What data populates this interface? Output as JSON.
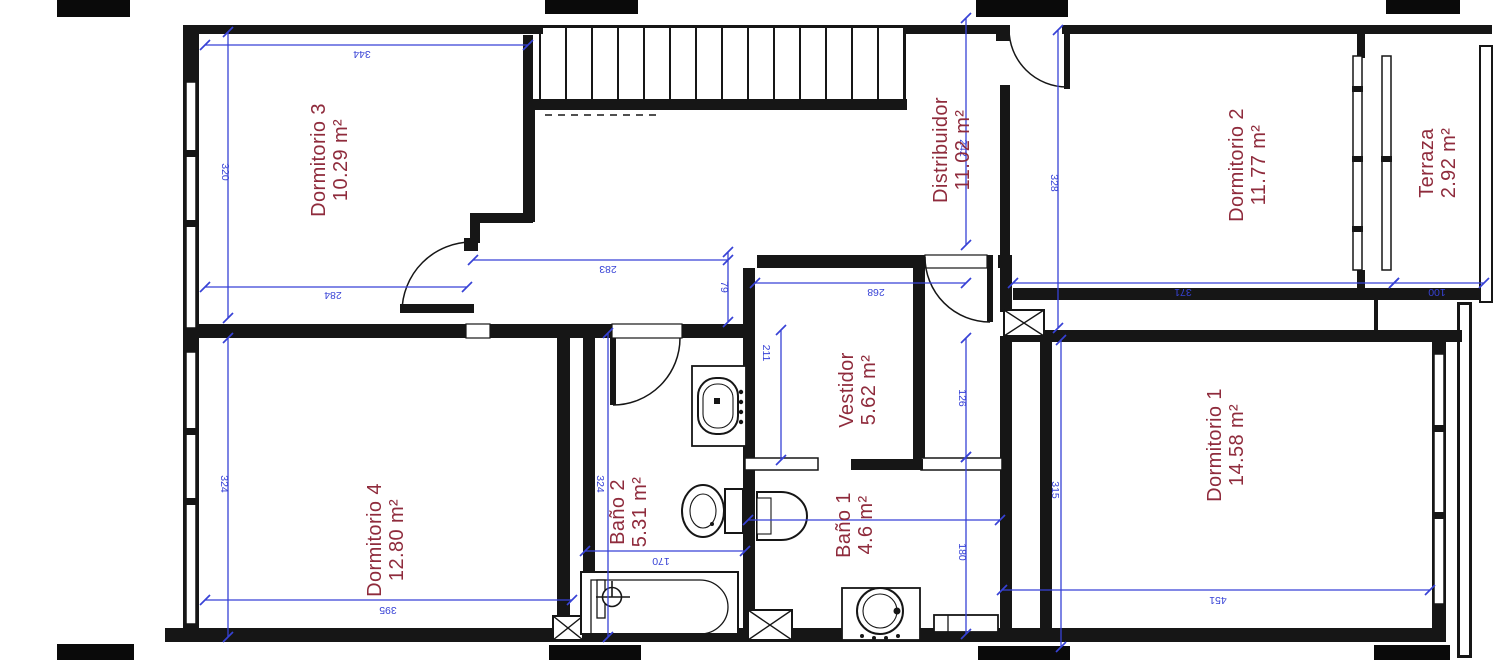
{
  "colors": {
    "wall": "#161616",
    "dimension_blue": "#3742d6",
    "label_red": "#8f2b3c",
    "paper": "#ffffff"
  },
  "rooms": {
    "dormitorio3": {
      "name": "Dormitorio 3",
      "area": "10.29 m²"
    },
    "distribuidor": {
      "name": "Distribuidor",
      "area": "11.02 m²"
    },
    "dormitorio2": {
      "name": "Dormitorio 2",
      "area": "11.77 m²"
    },
    "terraza": {
      "name": "Terraza",
      "area": "2.92 m²"
    },
    "vestidor": {
      "name": "Vestidor",
      "area": "5.62 m²"
    },
    "dormitorio4": {
      "name": "Dormitorio 4",
      "area": "12.80 m²"
    },
    "bano2": {
      "name": "Baño 2",
      "area": "5.31 m²"
    },
    "bano1": {
      "name": "Baño 1",
      "area": "4.6 m²"
    },
    "dormitorio1": {
      "name": "Dormitorio 1",
      "area": "14.58 m²"
    }
  },
  "dimensions_cm": {
    "d344": "344",
    "d320": "320",
    "d284": "284",
    "d283": "283",
    "d79": "79",
    "d268": "268",
    "d242": "242",
    "d328": "328",
    "d371": "371",
    "d100": "100",
    "d211": "211",
    "d324_bano2": "324",
    "d170": "170",
    "d126": "126",
    "d180": "180",
    "d315": "315",
    "d324_dorm4": "324",
    "d395": "395",
    "d451": "451"
  }
}
